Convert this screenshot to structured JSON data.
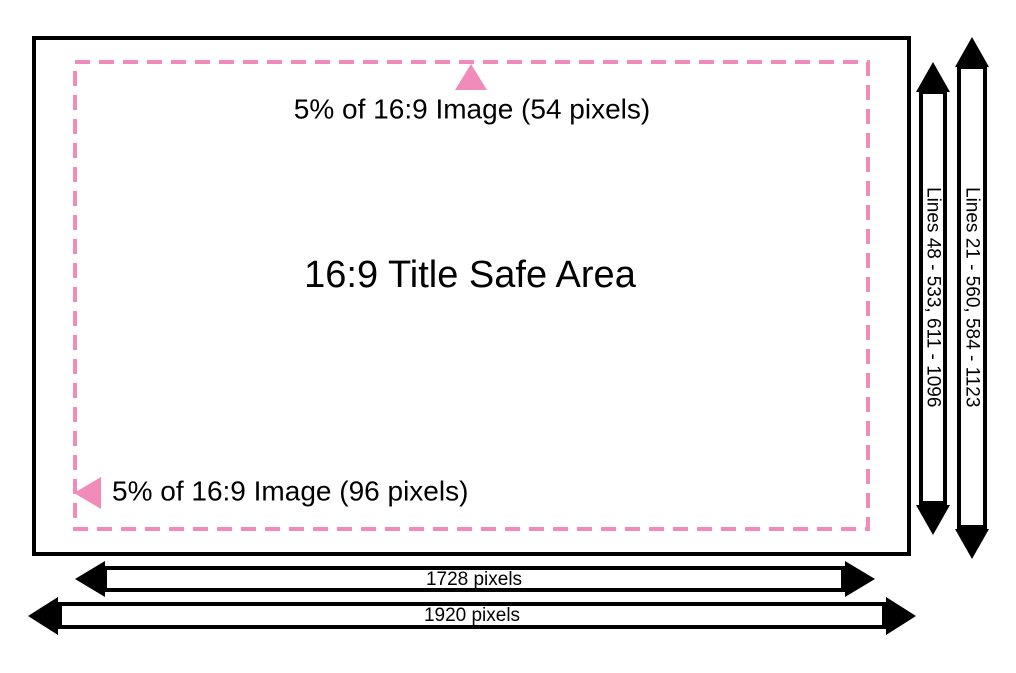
{
  "colors": {
    "accent_pink": "#F18CBA",
    "outline": "#000000"
  },
  "safe_area": {
    "title": "16:9 Title Safe Area",
    "top_margin_label": "5% of 16:9 Image (54 pixels)",
    "left_margin_label": "5% of 16:9 Image (96 pixels)"
  },
  "measurement_bars": {
    "safe_width": {
      "label": "1728 pixels"
    },
    "full_width": {
      "label": "1920 pixels"
    },
    "safe_lines": {
      "label": "Lines 48 - 533, 611 - 1096"
    },
    "full_lines": {
      "label": "Lines 21 - 560, 584 - 1123"
    }
  }
}
